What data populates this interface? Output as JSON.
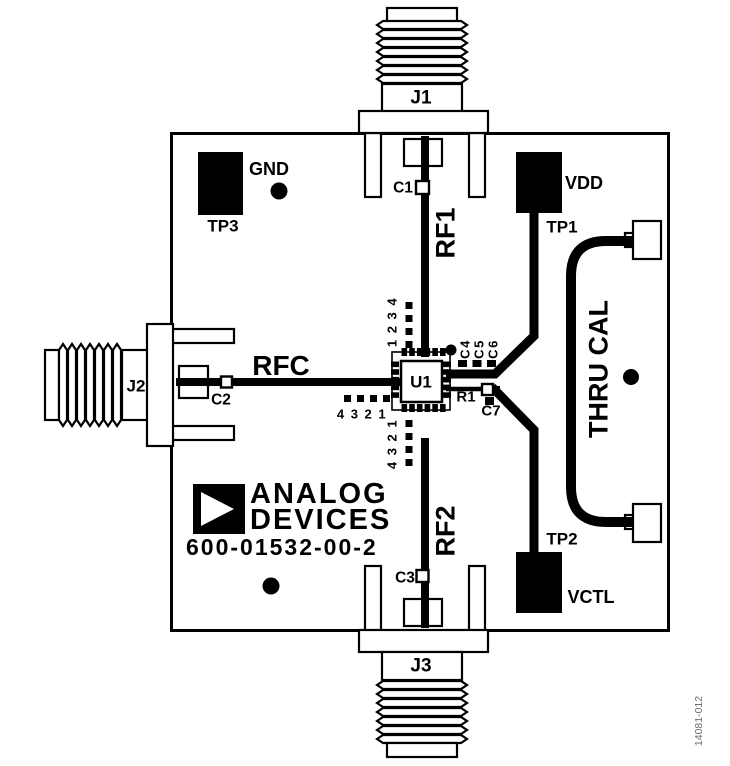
{
  "figure": {
    "doc_code": "14081-012"
  },
  "board": {
    "silkscreen": {
      "brand_line1": "ANALOG",
      "brand_line2": "DEVICES",
      "part_number": "600-01532-00-2"
    },
    "connectors": {
      "j1": "J1",
      "j2": "J2",
      "j3": "J3"
    },
    "test_points": {
      "tp1": {
        "ref": "TP1",
        "signal": "VDD"
      },
      "tp2": {
        "ref": "TP2",
        "signal": "VCTL"
      },
      "tp3": {
        "ref": "TP3",
        "signal": "GND"
      }
    },
    "traces": {
      "rf1": "RF1",
      "rf2": "RF2",
      "rfc": "RFC",
      "thru_cal": "THRU CAL"
    },
    "components": {
      "u1": "U1",
      "c1": "C1",
      "c2": "C2",
      "c3": "C3",
      "c4": "C4",
      "c5": "C5",
      "c6": "C6",
      "c7": "C7",
      "r1": "R1"
    },
    "pin_markers": {
      "u1_top_column": "1 2 3 4",
      "u1_left_row": "4 3 2 1",
      "u1_bottom_column": "4 3 2 1"
    }
  },
  "colors": {
    "ink": "#000000",
    "background": "#ffffff",
    "doc_code_gray": "#6e6e6e"
  }
}
